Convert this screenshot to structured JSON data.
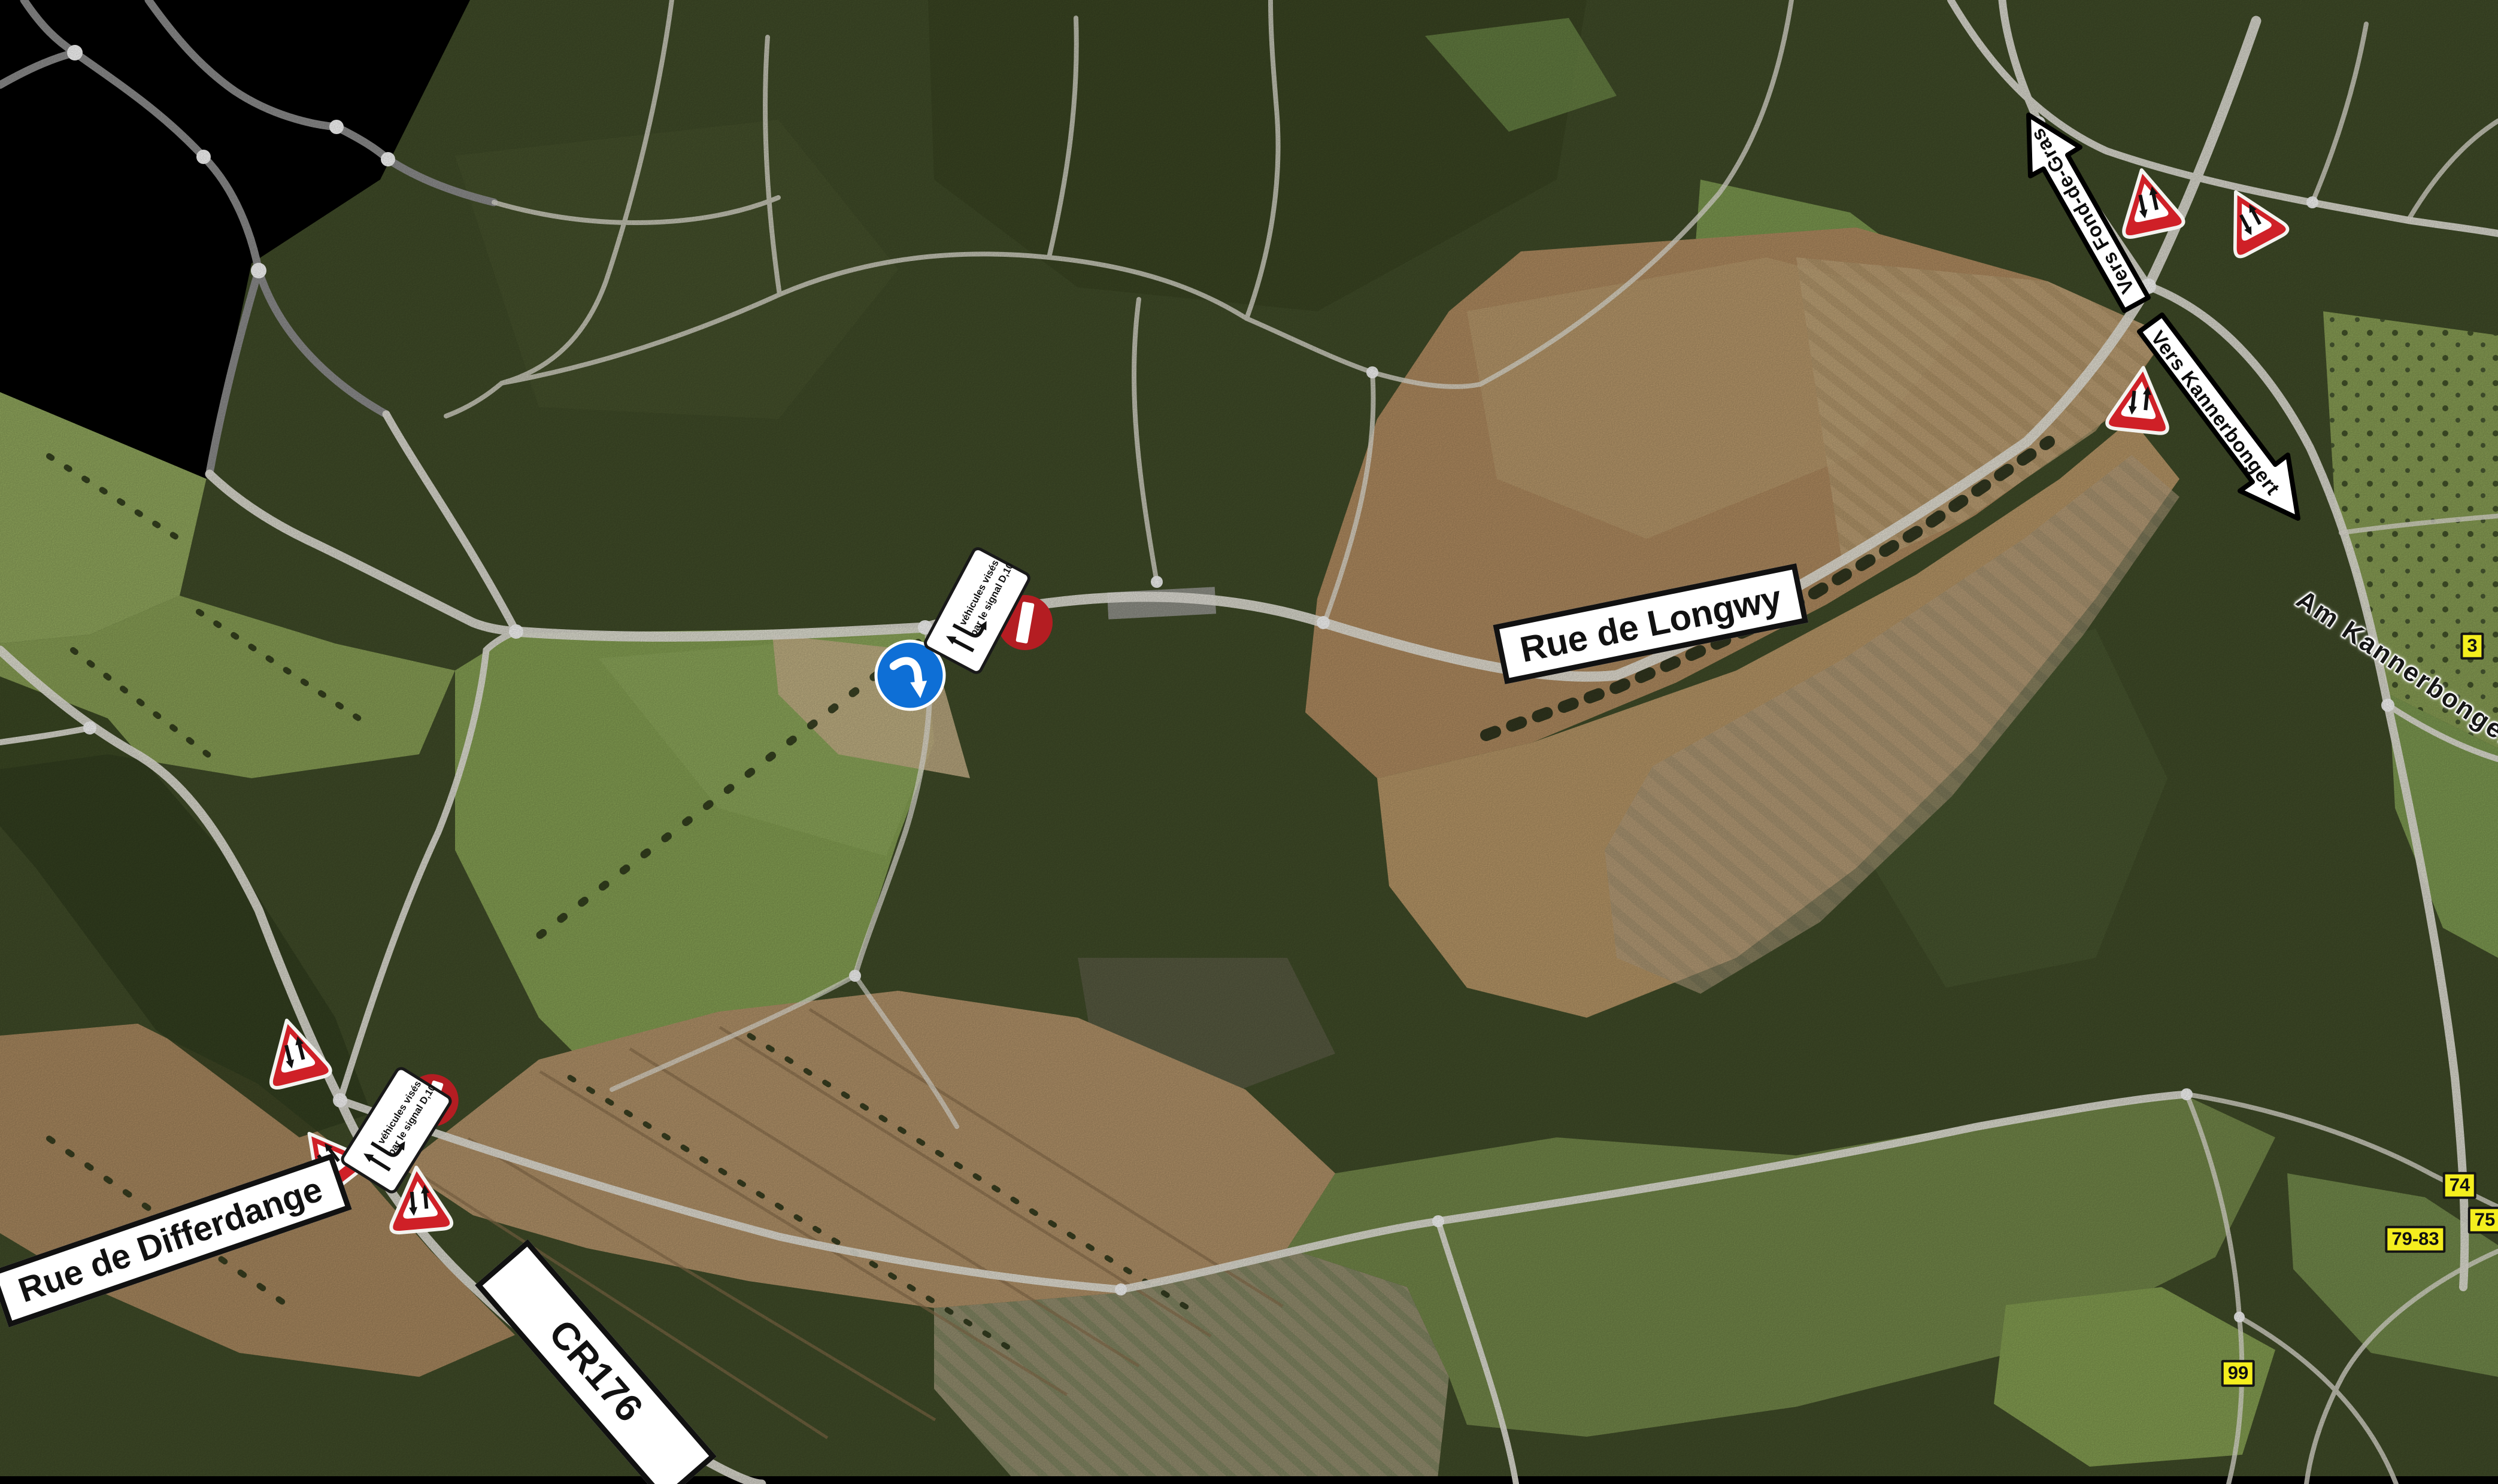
{
  "map": {
    "type": "aerial-orthophoto-with-road-overlay",
    "labels": {
      "rue_de_longwy": "Rue de Longwy",
      "rue_de_differdange": "Rue de Differdange",
      "cr176": "CR176",
      "fond_de_gras": "Vers Fond-de-Gras",
      "kannerbongert": "Vers Kannerbongert",
      "am_kannerbongert": "Am Kannerbongert"
    },
    "badges": {
      "b3": "3",
      "b74": "74",
      "b75": "75",
      "b79_83": "79-83",
      "b99": "99"
    },
    "plate": {
      "line1": "véhicules visés",
      "line2": "par le signal D,10"
    },
    "signs": {
      "two_way_traffic_warning_count": 6,
      "no_entry_count": 2,
      "mandatory_direction_count": 1,
      "exemption_plate_count": 2
    },
    "colors": {
      "warning_red": "#cf2027",
      "no_entry_red": "#b41d22",
      "mandatory_blue": "#0e6fd6",
      "badge_yellow": "#f4ee1e",
      "forest_green": "#414d29",
      "pasture_green": "#87a254",
      "field_brown": "#b28d61",
      "road_white": "#ebe9e0",
      "missing_imagery": "#000000"
    }
  }
}
